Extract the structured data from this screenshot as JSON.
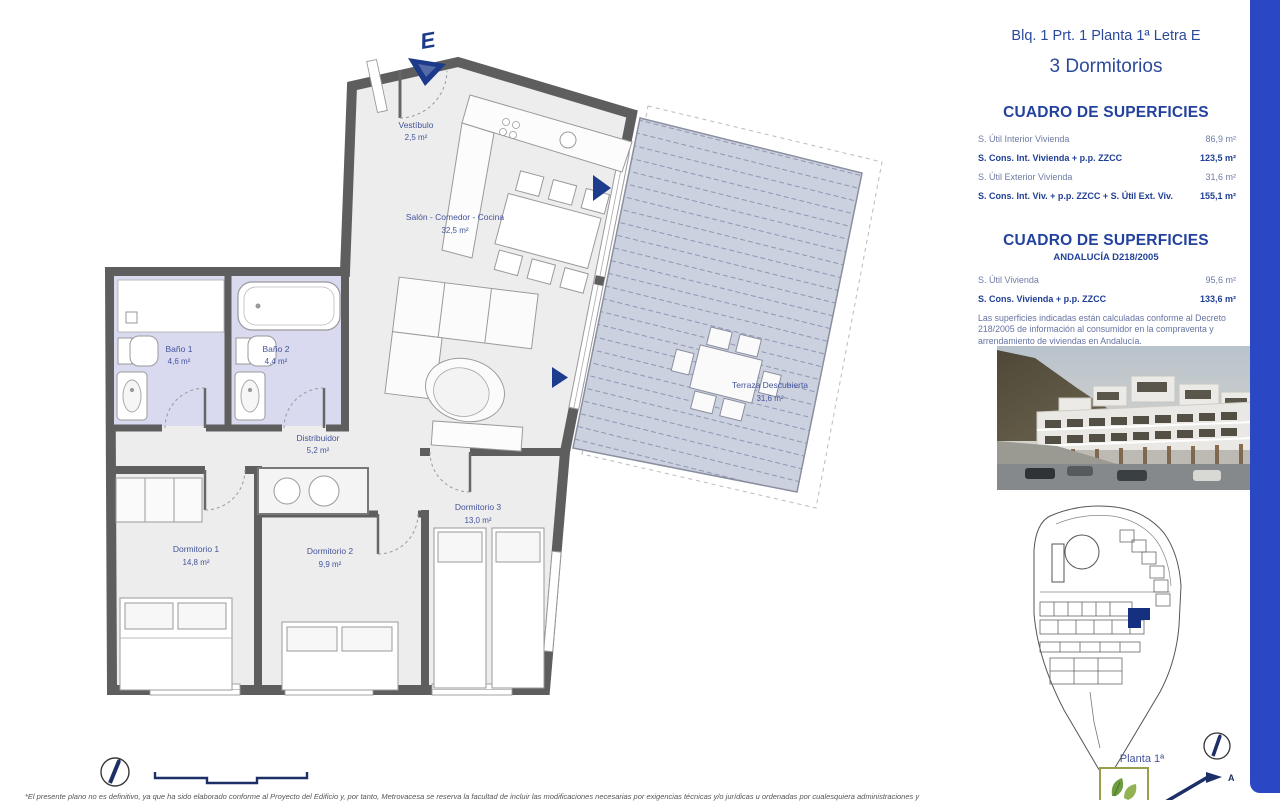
{
  "header": {
    "title_line": "Blq. 1 Prt. 1 Planta 1ª Letra E",
    "subtitle": "3 Dormitorios"
  },
  "surfaces_table_1": {
    "title": "CUADRO DE SUPERFICIES",
    "rows": [
      {
        "label": "S. Útil Interior Vivienda",
        "value": "86,9 m²"
      },
      {
        "label": "S. Cons. Int. Vivienda + p.p. ZZCC",
        "value": "123,5 m²"
      },
      {
        "label": "S. Útil Exterior Vivienda",
        "value": "31,6 m²"
      },
      {
        "label": "S. Cons. Int. Viv. + p.p. ZZCC + S. Útil Ext. Viv.",
        "value": "155,1 m²"
      }
    ]
  },
  "surfaces_table_2": {
    "title": "CUADRO DE SUPERFICIES",
    "subtitle": "ANDALUCÍA D218/2005",
    "rows": [
      {
        "label": "S. Útil Vivienda",
        "value": "95,6 m²"
      },
      {
        "label": "S. Cons. Vivienda + p.p. ZZCC",
        "value": "133,6 m²"
      }
    ],
    "note": "Las superficies indicadas están calculadas conforme al Decreto 218/2005 de información al consumidor en la compraventa y arrendamiento de viviendas en Andalucía."
  },
  "floorplan": {
    "entrance_label": "E",
    "rooms": [
      {
        "name": "Vestíbulo",
        "area": "2,5 m²"
      },
      {
        "name": "Salón - Comedor - Cocina",
        "area": "32,5 m²"
      },
      {
        "name": "Baño 1",
        "area": "4,6 m²"
      },
      {
        "name": "Baño 2",
        "area": "4,4 m²"
      },
      {
        "name": "Distribuidor",
        "area": "5,2 m²"
      },
      {
        "name": "Dormitorio 1",
        "area": "14,8 m²"
      },
      {
        "name": "Dormitorio 2",
        "area": "9,9 m²"
      },
      {
        "name": "Dormitorio 3",
        "area": "13,0 m²"
      },
      {
        "name": "Terraza Descubierta",
        "area": "31,6 m²"
      }
    ]
  },
  "siteplan": {
    "floor_label": "Planta 1ª",
    "north_label": "A"
  },
  "footer": {
    "disclaimer": "*El presente plano no es definitivo, ya que ha sido elaborado conforme al Proyecto del Edificio y, por tanto, Metrovacesa se reserva la facultad de incluir las modificaciones necesarias por exigencias técnicas y/o jurídicas u ordenadas por cualesquiera administraciones y"
  },
  "colors": {
    "accent_blue": "#2a48c4",
    "heading_blue": "#23429e",
    "wall_grey": "#5e5e5e",
    "bathroom_fill": "#d9daf0",
    "terrace_fill": "#ccd1df"
  }
}
